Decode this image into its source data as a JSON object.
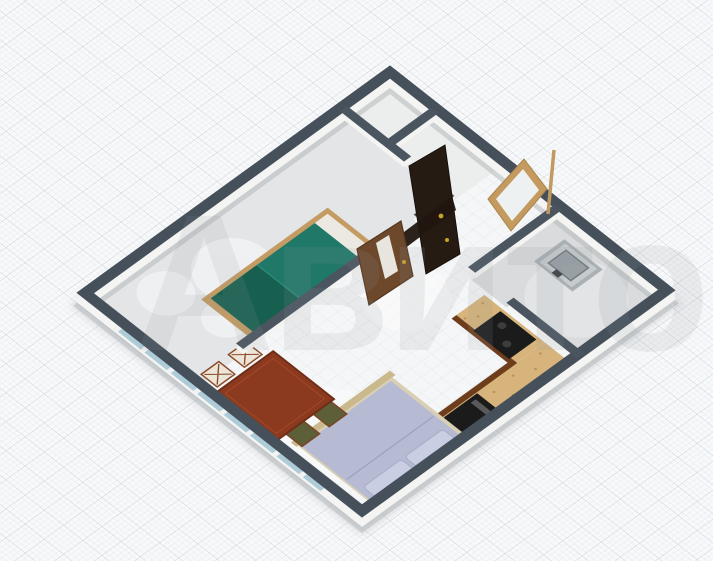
{
  "scene": {
    "type": "3d-floor-plan-render",
    "description": "Isometric 3D floor plan of a one-bedroom apartment on graph paper background",
    "rooms": [
      {
        "name": "bedroom",
        "note": "green single bed"
      },
      {
        "name": "living-room",
        "note": "double bed, dining table, kitchen counter"
      },
      {
        "name": "kitchen-room",
        "note": "gray floor, sink unit"
      },
      {
        "name": "bathroom",
        "note": "small rooms at top"
      },
      {
        "name": "hallway",
        "note": "mirror and doors"
      }
    ]
  },
  "watermark": {
    "text": "Авито",
    "color": "#8f979d",
    "opacity": "0.13"
  },
  "canvas": {
    "background": "#f8f9fa",
    "grid_major": "#ccd3d8",
    "grid_minor": "#e8ecef"
  },
  "walls": {
    "top_color": "#45505b",
    "top_color_inner": "#4a5560",
    "face_color": "#f4f4f3",
    "shadow_color": "#b4b9bc"
  },
  "floors": {
    "main_tile": "#f5f6f7",
    "tile_line": "#e6e9eb",
    "bedroom": "#e4e5e6",
    "kitchen": "#d9dbdc",
    "small_rooms": "#eceded",
    "circle_light": "#f1f2f3",
    "circle_gray": "#e2e4e5"
  },
  "furniture": {
    "single_bed": {
      "label": "single bed with green blanket",
      "blanket": "#1f7868",
      "blanket_dark": "#17604f",
      "fold": "#2b8a77",
      "frame": "#c49b62",
      "sheet": "#ece9e2"
    },
    "double_bed": {
      "label": "double bed",
      "mattress": "#b6bbd3",
      "pillow": "#c9cee2",
      "pillow_edge": "#a9b0ca",
      "base": "#d9cfb4",
      "frame": "#cbb98e",
      "fold": "#9aa1bb"
    },
    "dining_table": {
      "label": "wooden dining table",
      "top": "#8b3a1f",
      "edge": "#6f2d16",
      "inner": "#a34a28"
    },
    "chairs": {
      "label": "four chairs",
      "dark_seat": "#5c5f38",
      "light_seat": "#ece5d8",
      "frame": "#7a4526",
      "cross": "#8a4a2a"
    },
    "kitchen_counter": {
      "label": "L-shaped kitchen counter",
      "top": "#d7b47c",
      "speckle": "#bb945c",
      "cabinet": "#6e3d1c",
      "cooktop": "#1b1b1b",
      "appliance_slit": "#5a5a5a"
    },
    "sink": {
      "label": "sink unit",
      "body": "#aab0b3",
      "top": "#c6cbcd",
      "basin": "#98a0a4",
      "basin_edge": "#707a7e",
      "faucet": "#3a4044"
    },
    "door_dark": {
      "label": "dark entrance door",
      "color": "#261b13",
      "color2": "#20160f",
      "handle": "#c9a227"
    },
    "door_brown": {
      "label": "wooden room door",
      "color": "#6d482b",
      "edge": "#553620",
      "panel": "#e8e4de",
      "handle": "#caa22a"
    },
    "mirror": {
      "label": "leaning mirror",
      "frame": "#c49a5e",
      "glass": "#eef1f1"
    },
    "broom": {
      "label": "leaning stick",
      "color": "#c09a5e"
    },
    "window": {
      "label": "window strip",
      "glass": "#aecbd8",
      "mullion": "#f2f2f2"
    }
  }
}
